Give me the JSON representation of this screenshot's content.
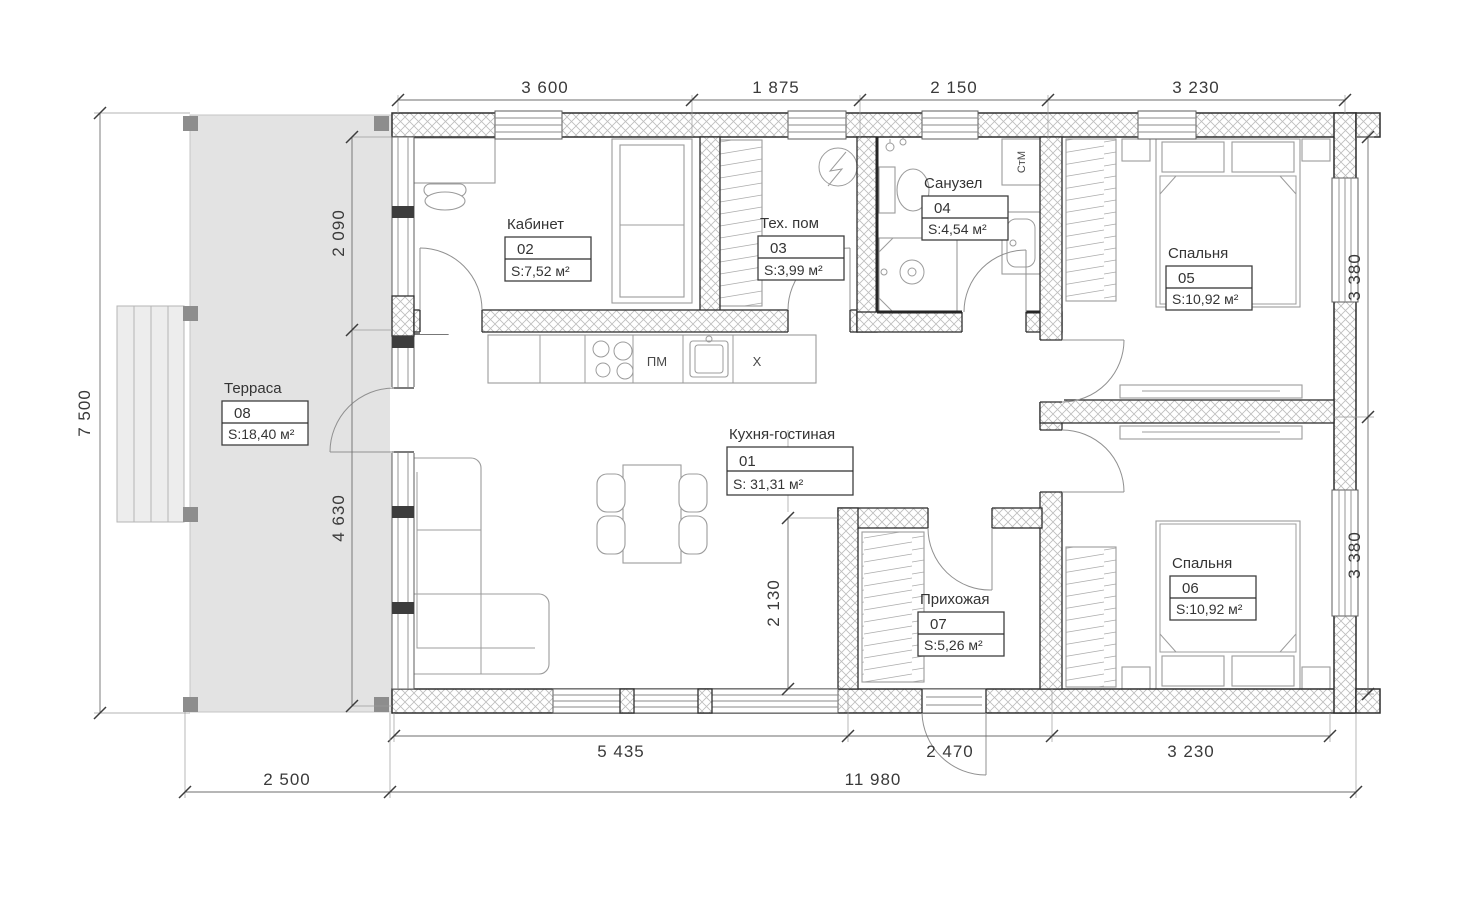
{
  "plan": {
    "type": "floor-plan",
    "rooms": [
      {
        "number": "01",
        "name": "Кухня-гостиная",
        "area": "S:   31,31 м²"
      },
      {
        "number": "02",
        "name": "Кабинет",
        "area": "S:7,52 м²"
      },
      {
        "number": "03",
        "name": "Тех. пом",
        "area": "S:3,99 м²"
      },
      {
        "number": "04",
        "name": "Санузел",
        "area": "S:4,54 м²"
      },
      {
        "number": "05",
        "name": "Спальня",
        "area": "S:10,92 м²"
      },
      {
        "number": "06",
        "name": "Спальня",
        "area": "S:10,92 м²"
      },
      {
        "number": "07",
        "name": "Прихожая",
        "area": "S:5,26 м²"
      },
      {
        "number": "08",
        "name": "Терраса",
        "area": "S:18,40 м²"
      }
    ],
    "dims": {
      "top": [
        "3 600",
        "1 875",
        "2 150",
        "3 230"
      ],
      "bottom_inner": [
        "5 435",
        "2 470",
        "3 230"
      ],
      "bottom_outer": [
        "2 500",
        "11 980"
      ],
      "left_total": "7 500",
      "left_inner": [
        "2 090",
        "4 630"
      ],
      "right": [
        "3 380",
        "3 380"
      ],
      "interior": [
        "2 130"
      ]
    },
    "appliances": {
      "dishwasher": "ПМ",
      "fridge": "X",
      "washing_machine": "СтМ"
    },
    "colors": {
      "terrace_fill": "#e3e3e3",
      "wall_line": "#2e2e2e",
      "furniture_line": "#9c9c9c"
    }
  }
}
